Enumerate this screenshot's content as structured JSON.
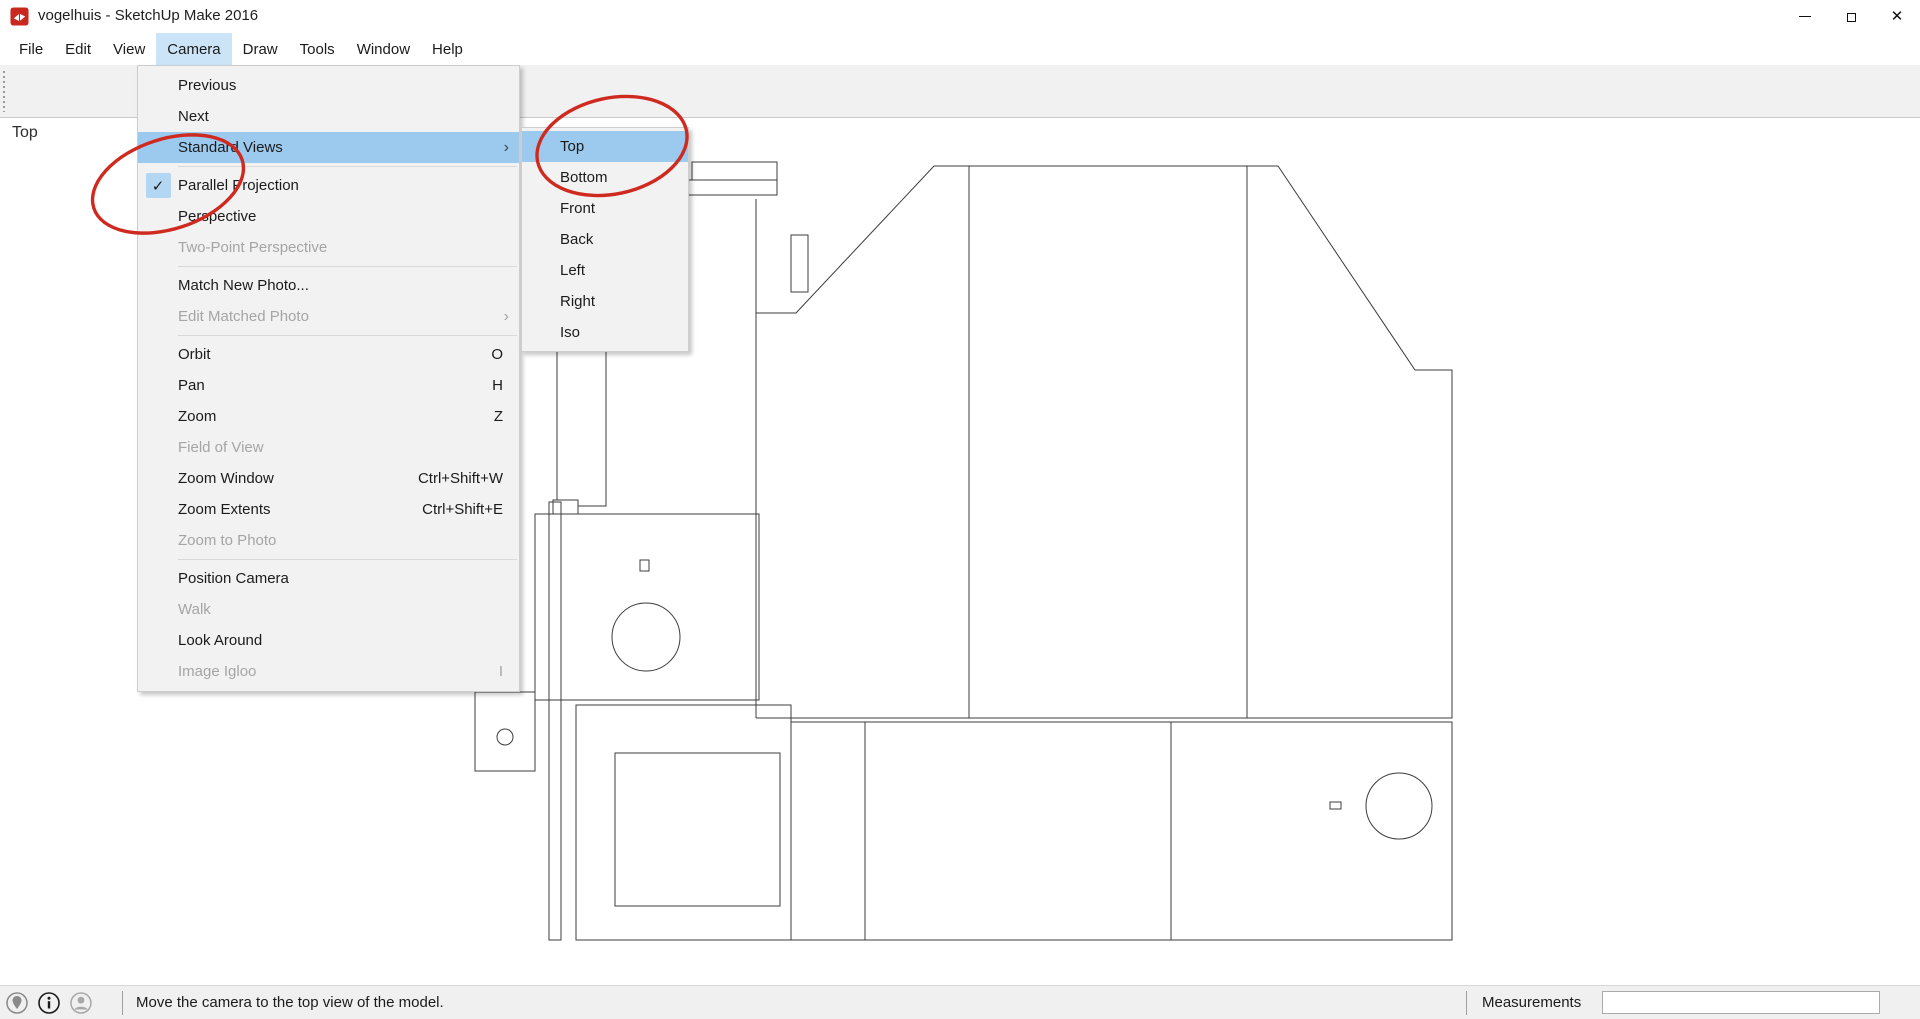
{
  "window": {
    "title": "vogelhuis - SketchUp Make 2016",
    "controls": [
      "minimize",
      "restore",
      "close"
    ]
  },
  "menubar": {
    "items": [
      {
        "label": "File"
      },
      {
        "label": "Edit"
      },
      {
        "label": "View"
      },
      {
        "label": "Camera",
        "active": true
      },
      {
        "label": "Draw"
      },
      {
        "label": "Tools"
      },
      {
        "label": "Window"
      },
      {
        "label": "Help"
      }
    ]
  },
  "toolbar": {
    "buttons": [
      {
        "name": "select",
        "active": true
      },
      {
        "name": "eraser"
      },
      {
        "name": "move-partial"
      },
      {
        "name": "push-pull"
      },
      {
        "name": "sep1",
        "separator": true
      },
      {
        "name": "tape-measure"
      },
      {
        "name": "text"
      },
      {
        "name": "paint-bucket"
      },
      {
        "name": "sep2",
        "separator": true
      },
      {
        "name": "orbit"
      },
      {
        "name": "pan"
      },
      {
        "name": "zoom"
      },
      {
        "name": "zoom-extents"
      },
      {
        "name": "sep3",
        "separator": true
      },
      {
        "name": "3d-warehouse"
      },
      {
        "name": "share-model"
      },
      {
        "name": "print",
        "disabled": true
      },
      {
        "name": "sep4",
        "separator": true
      }
    ]
  },
  "camera_menu": {
    "sections": [
      [
        {
          "label": "Previous"
        },
        {
          "label": "Next"
        },
        {
          "label": "Standard Views",
          "submenu": true,
          "highlighted": true
        }
      ],
      [
        {
          "label": "Parallel Projection",
          "checked": true
        },
        {
          "label": "Perspective"
        },
        {
          "label": "Two-Point Perspective",
          "disabled": true
        }
      ],
      [
        {
          "label": "Match New Photo..."
        },
        {
          "label": "Edit Matched Photo",
          "disabled": true,
          "submenu": true
        }
      ],
      [
        {
          "label": "Orbit",
          "shortcut": "O"
        },
        {
          "label": "Pan",
          "shortcut": "H"
        },
        {
          "label": "Zoom",
          "shortcut": "Z"
        },
        {
          "label": "Field of View",
          "disabled": true
        },
        {
          "label": "Zoom Window",
          "shortcut": "Ctrl+Shift+W"
        },
        {
          "label": "Zoom Extents",
          "shortcut": "Ctrl+Shift+E"
        },
        {
          "label": "Zoom to Photo",
          "disabled": true
        }
      ],
      [
        {
          "label": "Position Camera"
        },
        {
          "label": "Walk",
          "disabled": true
        },
        {
          "label": "Look Around"
        },
        {
          "label": "Image Igloo",
          "shortcut": "I",
          "disabled": true
        }
      ]
    ]
  },
  "standard_views_submenu": {
    "items": [
      {
        "label": "Top",
        "highlighted": true
      },
      {
        "label": "Bottom"
      },
      {
        "label": "Front"
      },
      {
        "label": "Back"
      },
      {
        "label": "Left"
      },
      {
        "label": "Right"
      },
      {
        "label": "Iso"
      }
    ]
  },
  "viewport": {
    "view_label": "Top"
  },
  "statusbar": {
    "icons": [
      "geolocation",
      "credits-info",
      "sign-in"
    ],
    "message": "Move the camera to the top view of the model.",
    "measurements_label": "Measurements",
    "measurements_value": ""
  },
  "colors": {
    "menu_highlight": "#9ccaef",
    "menubar_active": "#cce4f7",
    "annotation_red": "#cf2a1f",
    "drawing_stroke": "#3c3c3c"
  },
  "drawing": {
    "shapes": [
      {
        "t": "rect",
        "v": [
          692,
          162,
          85,
          18
        ]
      },
      {
        "t": "rect",
        "v": [
          683,
          180,
          94,
          15
        ]
      },
      {
        "t": "path",
        "v": "M557,195 V500"
      },
      {
        "t": "path",
        "v": "M606,195 V506 H578"
      },
      {
        "t": "rect",
        "v": [
          553,
          500,
          25,
          14
        ]
      },
      {
        "t": "rect",
        "v": [
          549,
          502,
          12,
          438
        ]
      },
      {
        "t": "rect",
        "v": [
          535,
          514,
          224,
          186
        ]
      },
      {
        "t": "rect",
        "v": [
          640,
          560,
          9,
          11
        ]
      },
      {
        "t": "circle",
        "v": [
          646,
          637,
          34
        ]
      },
      {
        "t": "rect",
        "v": [
          475,
          692,
          60,
          79
        ]
      },
      {
        "t": "circle",
        "v": [
          505,
          737,
          8
        ]
      },
      {
        "t": "path",
        "v": "M756,199 V718"
      },
      {
        "t": "path",
        "v": "M756,313 H796 L934,166 H1278 L1415,370 H1452 V718 H756"
      },
      {
        "t": "path",
        "v": "M969,166 V718"
      },
      {
        "t": "path",
        "v": "M1247,166 V718"
      },
      {
        "t": "rect",
        "v": [
          791,
          235,
          17,
          57
        ]
      },
      {
        "t": "path",
        "v": "M791,722 H1452 V940 H791 V722"
      },
      {
        "t": "path",
        "v": "M865,722 V940"
      },
      {
        "t": "path",
        "v": "M1171,722 V940"
      },
      {
        "t": "rect",
        "v": [
          576,
          705,
          215,
          235
        ]
      },
      {
        "t": "rect",
        "v": [
          615,
          753,
          165,
          153
        ]
      },
      {
        "t": "circle",
        "v": [
          1399,
          806,
          33
        ]
      },
      {
        "t": "rect",
        "v": [
          1330,
          802,
          11,
          7
        ]
      }
    ]
  },
  "annotations": {
    "ellipses": [
      {
        "name": "annotation-circle-parallel-projection",
        "cx": 168,
        "cy": 184,
        "rx": 78,
        "ry": 45,
        "rot": -18
      },
      {
        "name": "annotation-circle-top",
        "cx": 612,
        "cy": 146,
        "rx": 76,
        "ry": 48,
        "rot": -12
      }
    ]
  }
}
